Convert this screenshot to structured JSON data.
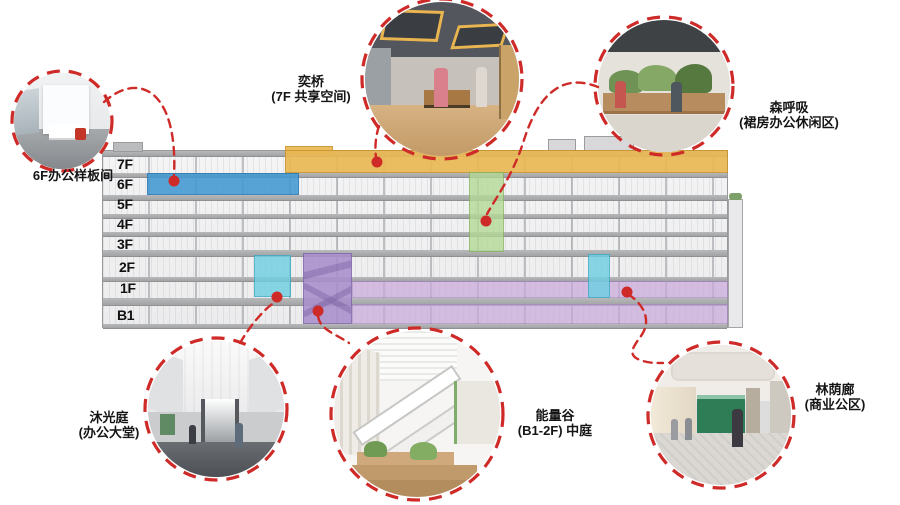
{
  "colors": {
    "accent": "#ce2a28",
    "zoneYellow": "#eab955",
    "zoneYellowEdge": "#c9952f",
    "zoneBlue": "#4299d3",
    "zoneBlueEdge": "#2478b4",
    "zoneGreen": "#b3d994",
    "zoneGreenEdge": "#84b55e",
    "zoneCyan": "#6fcfe2",
    "zoneCyanEdge": "#3aabc6",
    "zonePurple": "#a98fcb",
    "zonePurpleEdge": "#7f66ab",
    "zonePurpleLight": "#c9aadb"
  },
  "floors": [
    "7F",
    "6F",
    "5F",
    "4F",
    "3F",
    "2F",
    "1F",
    "B1"
  ],
  "callouts": {
    "showroom": {
      "label": "6F办公样板间"
    },
    "yiqiao": {
      "line1": "奕桥",
      "line2": "(7F 共享空间)"
    },
    "forest": {
      "line1": "森呼吸",
      "line2": "(裙房办公休闲区)"
    },
    "lobby": {
      "line1": "沐光庭",
      "line2": "(办公大堂)"
    },
    "energy": {
      "line1": "能量谷",
      "line2": "(B1-2F) 中庭"
    },
    "arcade": {
      "line1": "林荫廊",
      "line2": "(商业公区)"
    }
  }
}
